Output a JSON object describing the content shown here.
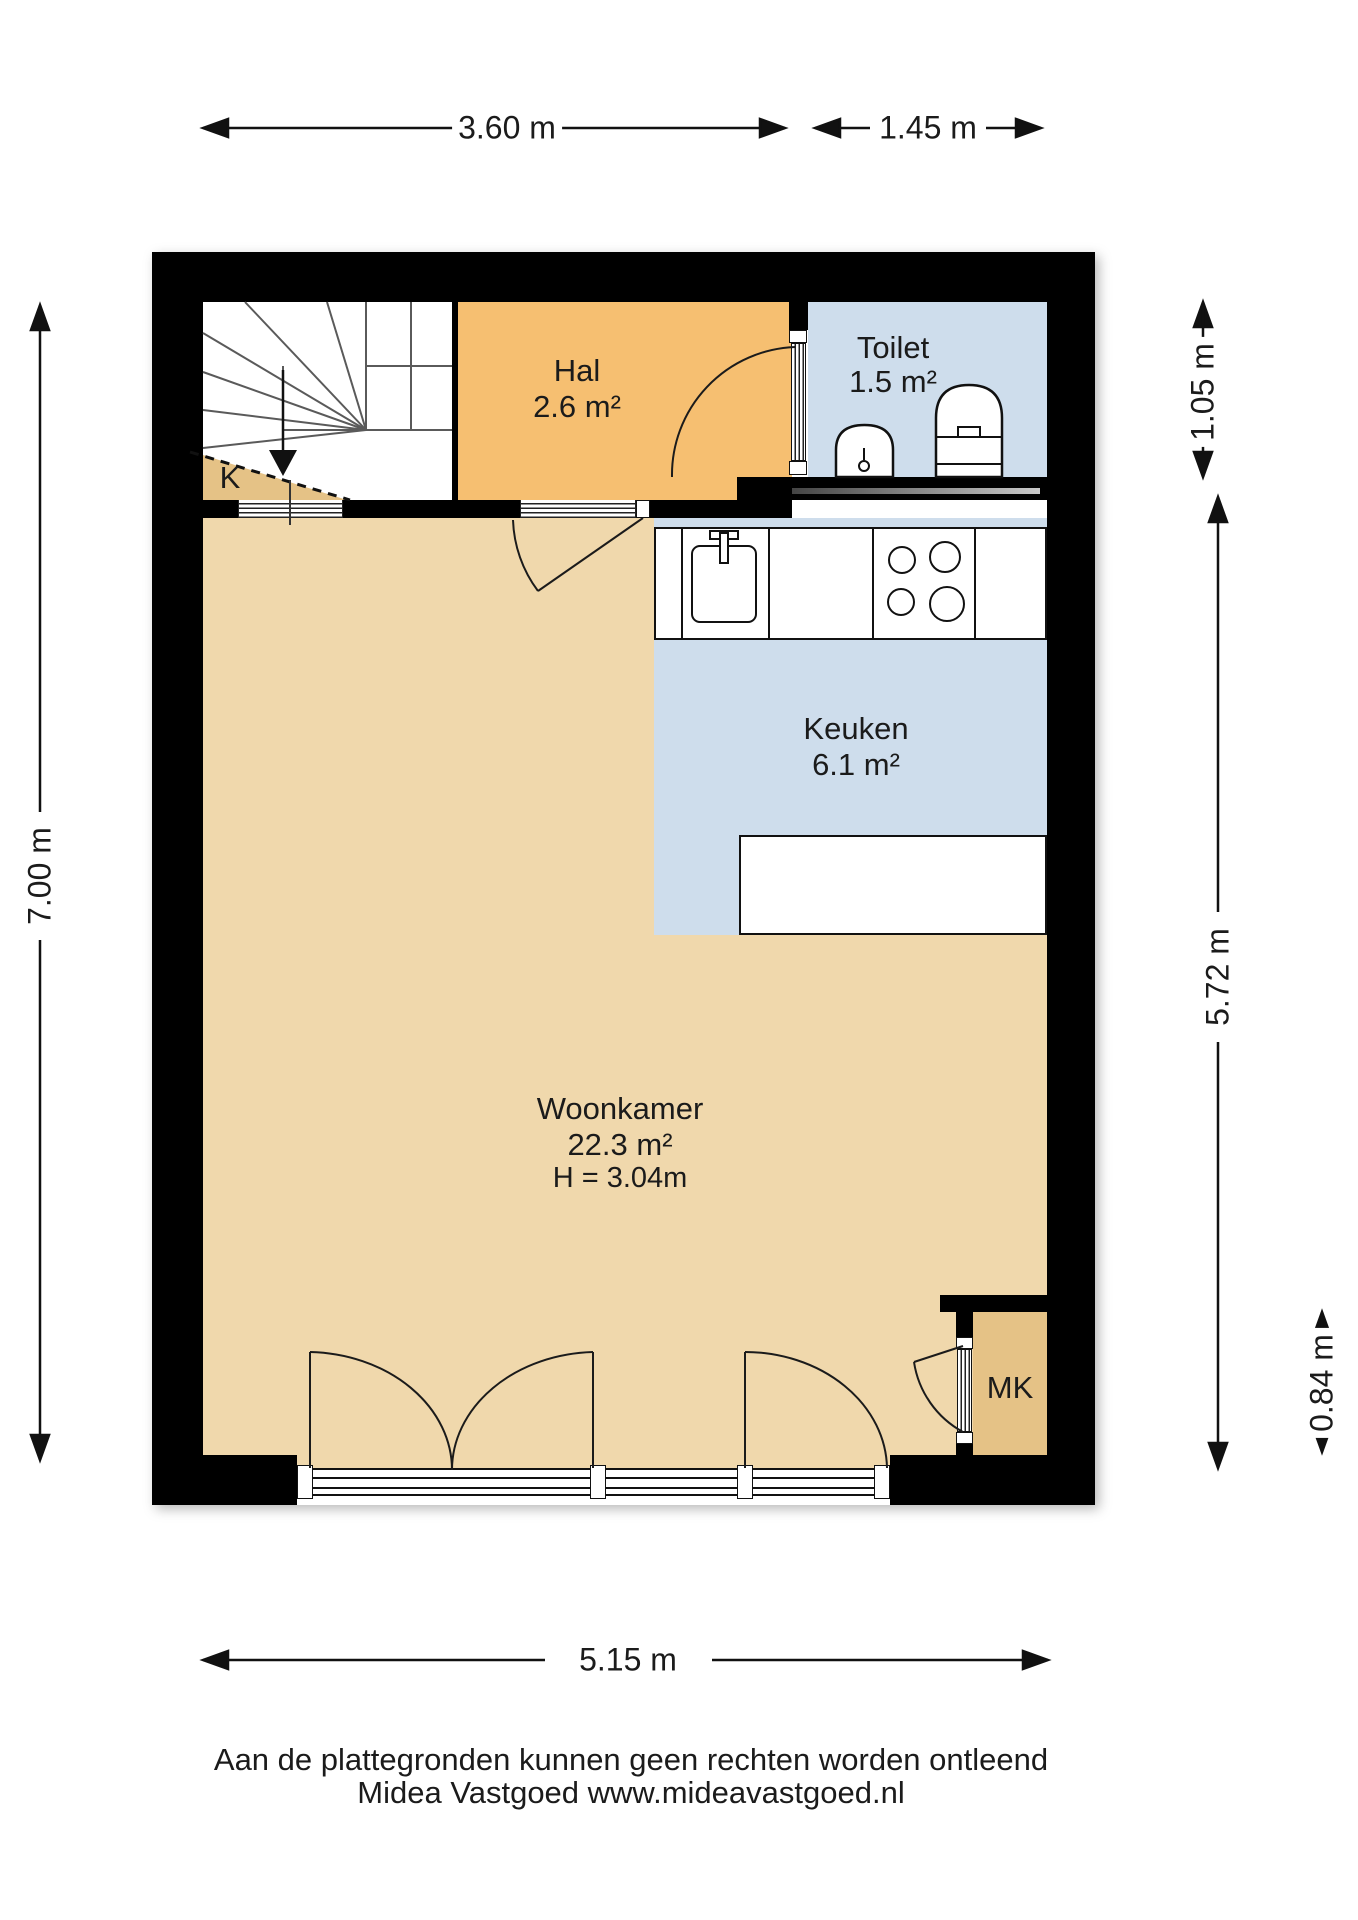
{
  "plan": {
    "rooms": {
      "hal": {
        "name": "Hal",
        "area": "2.6 m²"
      },
      "toilet": {
        "name": "Toilet",
        "area": "1.5 m²"
      },
      "keuken": {
        "name": "Keuken",
        "area": "6.1 m²"
      },
      "woonkamer": {
        "name": "Woonkamer",
        "area": "22.3 m²",
        "ceiling_height": "H = 3.04m"
      },
      "kast": {
        "name": "K"
      },
      "meterkast": {
        "name": "MK"
      }
    },
    "dimensions": {
      "top_left": "3.60 m",
      "top_right": "1.45 m",
      "left": "7.00 m",
      "right_top": "1.05 m",
      "right_middle": "5.72 m",
      "right_bottom": "0.84 m",
      "bottom": "5.15 m"
    },
    "colors": {
      "hal": "#F6BF71",
      "toilet": "#CEDDEC",
      "keuken": "#CEDDEC",
      "woonkamer": "#F0D8AC",
      "closet": "#E5C286",
      "wall": "#000000",
      "line": "#1B1B1B"
    }
  },
  "footer": {
    "line1": "Aan de plattegronden kunnen geen rechten worden ontleend",
    "line2": "Midea Vastgoed www.mideavastgoed.nl"
  }
}
